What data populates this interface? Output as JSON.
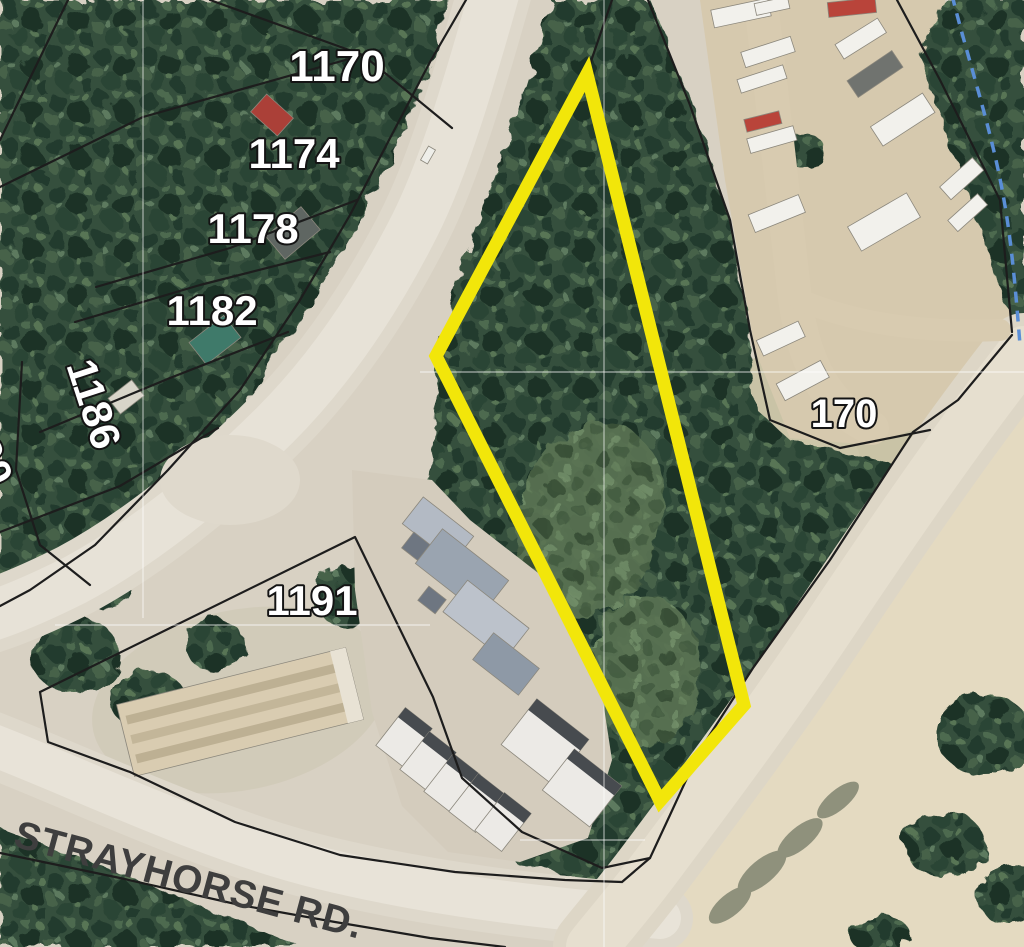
{
  "map": {
    "description": "Aerial orthophoto parcel map with one lot outlined in yellow",
    "road_label": {
      "text": "STRAYHORSE RD.",
      "color": "#3e3e3e"
    },
    "parcel_labels": [
      {
        "key": "1170",
        "text": "1170"
      },
      {
        "key": "1174",
        "text": "1174"
      },
      {
        "key": "1178",
        "text": "1178"
      },
      {
        "key": "1182",
        "text": "1182"
      },
      {
        "key": "1186",
        "text": "1186"
      },
      {
        "key": "partial",
        "text": "90"
      },
      {
        "key": "1191",
        "text": "1191"
      },
      {
        "key": "170",
        "text": "170"
      }
    ],
    "highlight_parcel": {
      "points": "587,74 436,356 660,801 744,705",
      "stroke": "#f2e60a",
      "stroke_width": "13"
    },
    "stream_line": {
      "color": "#5a8ed6",
      "style": "dashed"
    },
    "colors": {
      "parcel_boundary": "#1d1d1d",
      "label_fill": "#ffffff",
      "label_outline": "#141414",
      "forest": "#35503e",
      "road_surface": "#e6e1d6",
      "sand": "#e4dac1"
    }
  }
}
